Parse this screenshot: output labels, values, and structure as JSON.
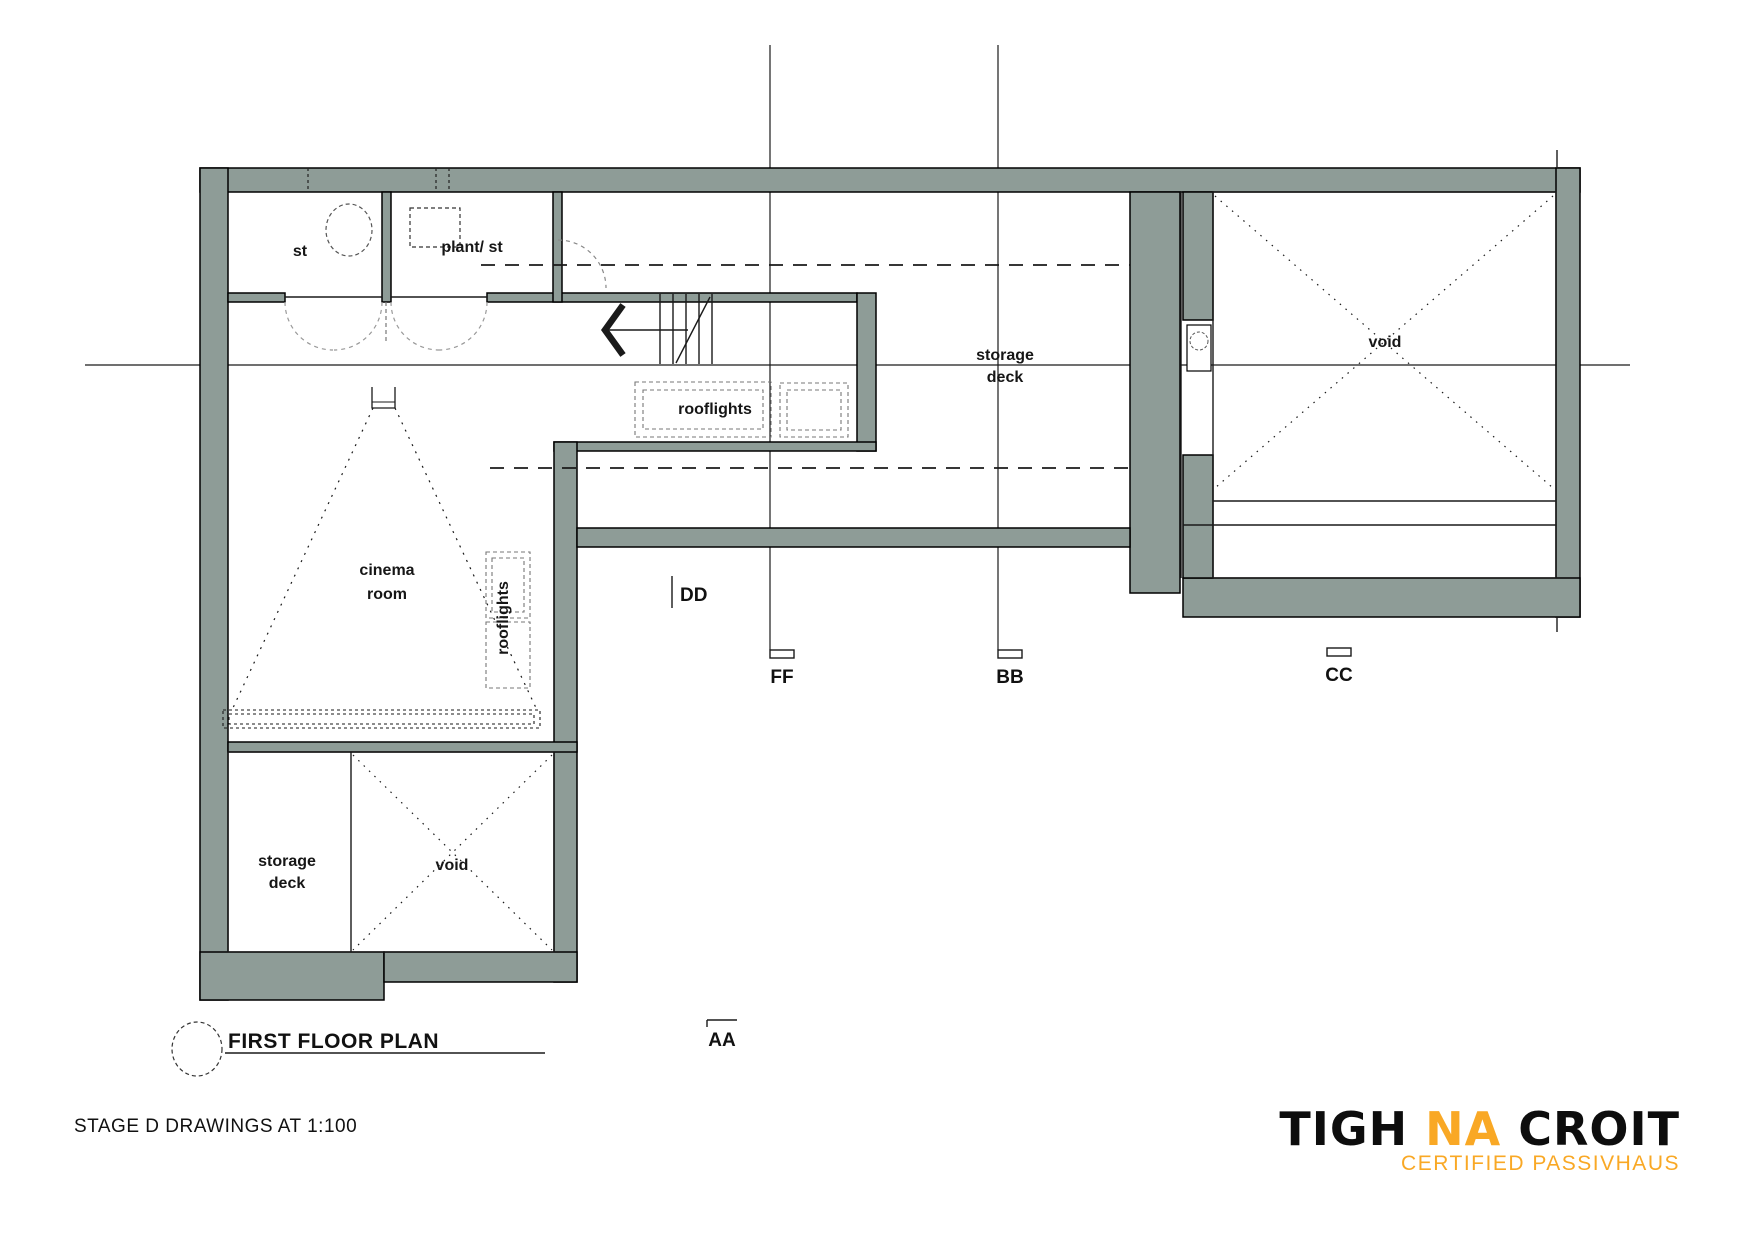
{
  "colors": {
    "wall": "#8E9C97",
    "accent": "#F9A825",
    "line": "#161616"
  },
  "labels": {
    "st": "st",
    "plant": "plant/ st",
    "storage_upper_1": "storage",
    "storage_upper_2": "deck",
    "rooflights_h": "rooflights",
    "cinema_1": "cinema",
    "cinema_2": "room",
    "rooflights_v": "rooflights",
    "storage_lower_1": "storage",
    "storage_lower_2": "deck",
    "void_lower": "void",
    "void_upper": "void"
  },
  "sections": {
    "dd": "DD",
    "ff": "FF",
    "bb": "BB",
    "cc": "CC",
    "aa": "AA"
  },
  "title": "FIRST FLOOR PLAN",
  "footer": {
    "note": "STAGE D DRAWINGS AT 1:100"
  },
  "logo": {
    "word1": "TIGH",
    "word2": "NA",
    "word3": "CROIT",
    "subtitle": "CERTIFIED PASSIVHAUS"
  }
}
